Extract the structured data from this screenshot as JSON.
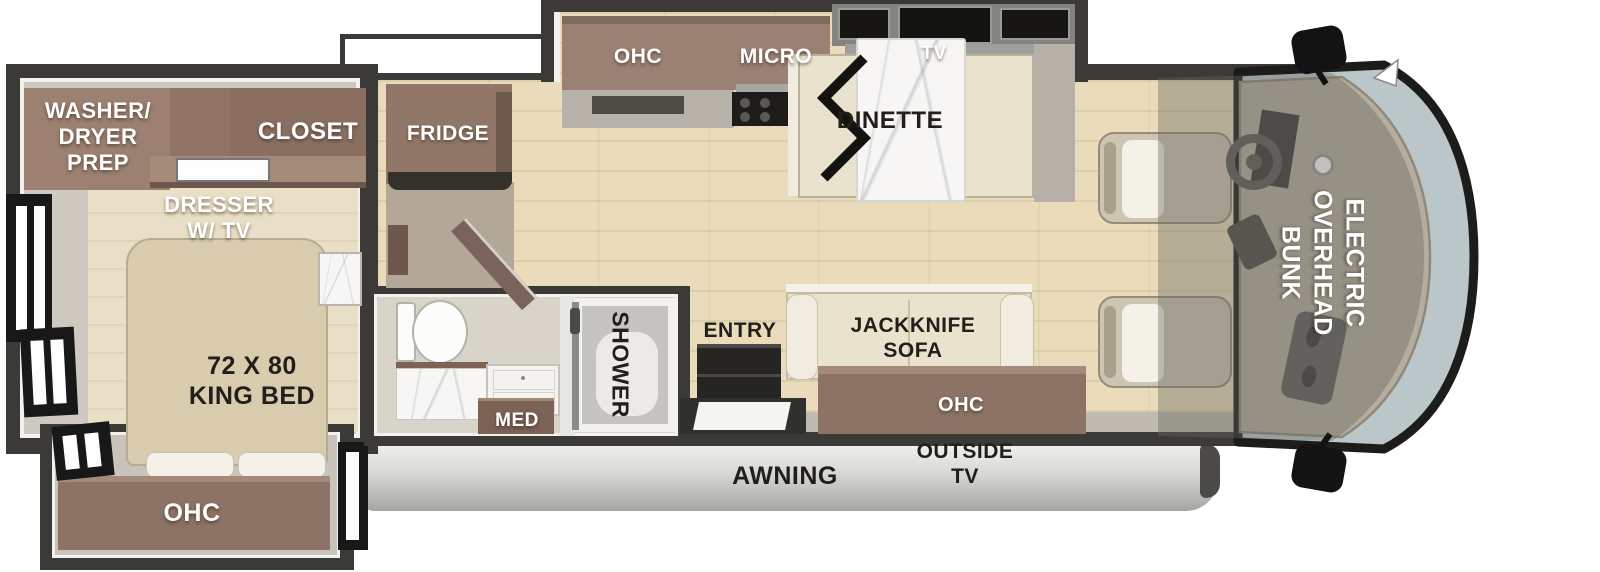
{
  "floorplan": {
    "title": "Class A motorhome floor plan",
    "rooms": {
      "bedroom": {
        "washer_dryer_prep": "WASHER/\nDRYER\nPREP",
        "closet": "CLOSET",
        "dresser": "DRESSER\nW/ TV",
        "bed": "72 X 80\nKING BED",
        "ohc": "OHC"
      },
      "kitchen": {
        "fridge": "FRIDGE",
        "ohc": "OHC",
        "micro": "MICRO"
      },
      "dinette": {
        "label": "DINETTE",
        "tv": "TV"
      },
      "bathroom": {
        "shower": "SHOWER",
        "med": "MED"
      },
      "living": {
        "entry": "ENTRY",
        "sofa": "JACKKNIFE\nSOFA",
        "ohc": "OHC"
      },
      "exterior": {
        "awning": "AWNING",
        "outside_tv": "OUTSIDE\nTV"
      },
      "cab": {
        "bunk": "ELECTRIC\nOVERHEAD\nBUNK"
      }
    },
    "colors": {
      "wall": "#3c3a37",
      "cabinet_brown": "#8d7365",
      "wood_floor": "#eadcbb",
      "windshield_glass": "#bac6c7",
      "awning_gray": "#c9c9c7",
      "upholstery_cream": "#e9e3ce",
      "marble": "#f7f6f4"
    }
  }
}
